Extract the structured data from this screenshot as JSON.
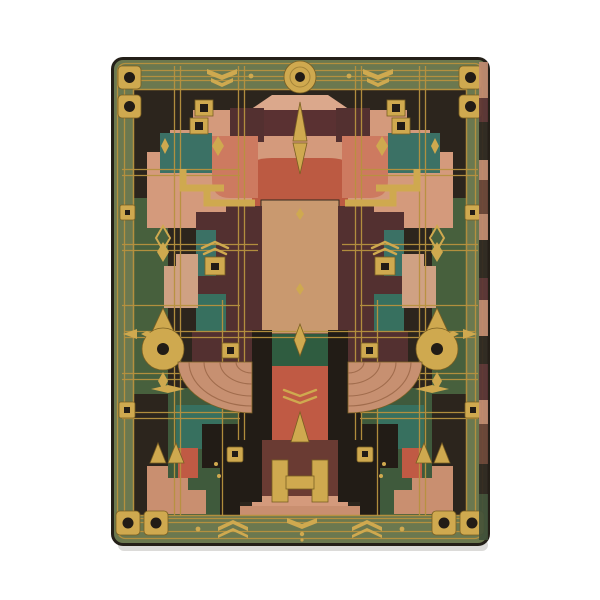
{
  "scene": {
    "description": "Hardcover journal photographed on a white background; the front cover bears a symmetric Art Deco Prairie-style ornament of gold foil grids, discs, chevrons and geometric blocks in green, teal, salmon, copper, terracotta and maroon leather",
    "background_color": "#ffffff"
  },
  "palette": {
    "edge": "#241f18",
    "ink": "#2c251d",
    "ink2": "#221c16",
    "border_green": "#6b784f",
    "green_dark": "#47603d",
    "green_mid": "#3f5a3c",
    "green_band": "#2f5c40",
    "teal": "#3b7165",
    "teal2": "#37705f",
    "gold": "#cfa94f",
    "gold_deep": "#b8923f",
    "gold_dark": "#7a5f22",
    "copper": "#c9996f",
    "copper2": "#cfa183",
    "fan_copper": "#c79071",
    "fan_line": "#9a6646",
    "salmon": "#d49a7c",
    "salmon_light": "#dba88c",
    "salmon_deep": "#c98f70",
    "terracotta": "#bc5a42",
    "red": "#c05a44",
    "red2": "#cd7a60",
    "maroon": "#533030",
    "maroon2": "#5a3132",
    "maroon3": "#6a3b33",
    "shadow": "rgba(35,30,20,0.16)",
    "fe1": "#c08a70",
    "fe2": "#5a3335",
    "fe3": "#2d2620",
    "fe4": "#6a4438",
    "fe5": "#3f4f38"
  }
}
